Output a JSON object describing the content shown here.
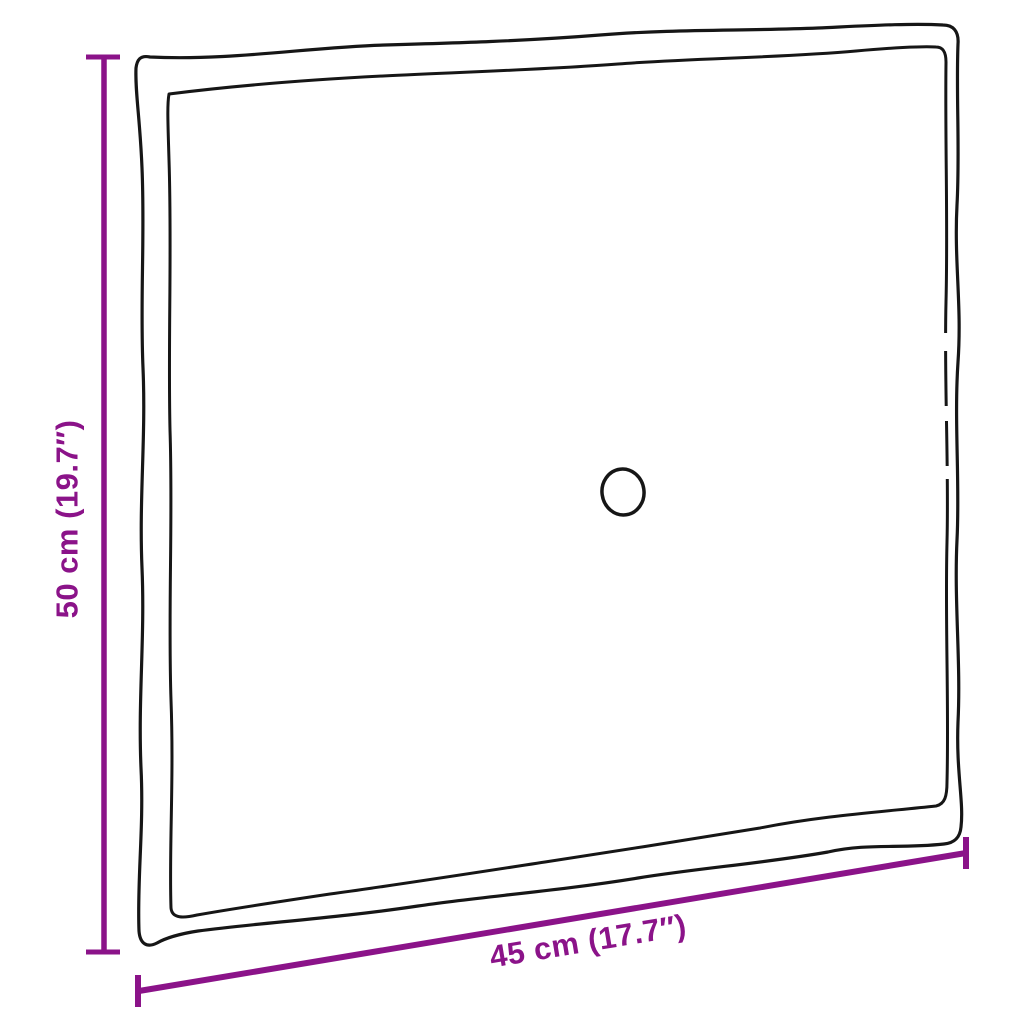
{
  "diagram": {
    "title": "cushion-dimension-diagram",
    "height_dimension": {
      "label": "50 cm (19.7″)"
    },
    "width_dimension": {
      "label": "45 cm (17.7″)"
    },
    "icons": {
      "cushion_button": "circle-outline"
    }
  },
  "colors": {
    "background": "#ffffff",
    "outline": "#161616",
    "accent": "#8B1389"
  }
}
